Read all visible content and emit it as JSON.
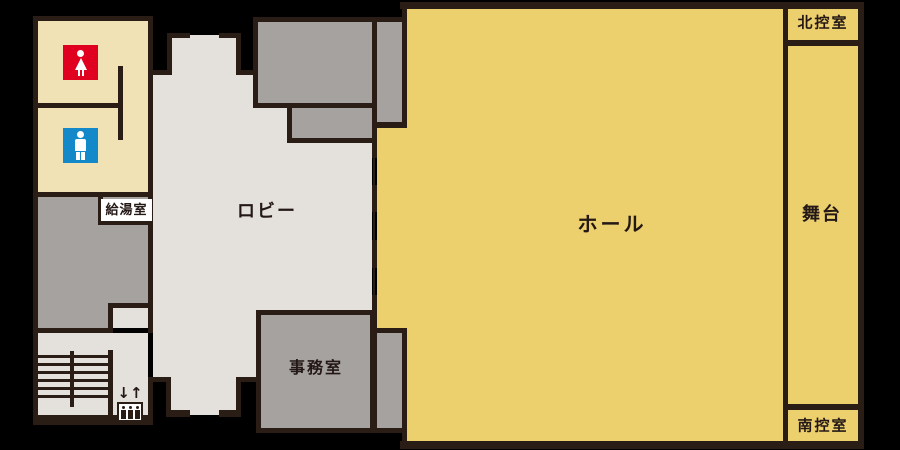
{
  "colors": {
    "bg": "#000000",
    "wall": "#2a1d15",
    "hall": "#edd06e",
    "cream": "#f0e2b5",
    "lobby": "#e4e1dd",
    "room": "#a5a2a0",
    "text": "#231815",
    "womens": "#e00020",
    "mens": "#1489ca",
    "white": "#ffffff"
  },
  "rooms": {
    "hall": "ホール",
    "stage": "舞台",
    "north_room": "北控室",
    "south_room": "南控室",
    "lobby": "ロビー",
    "office": "事務室",
    "kitchenette": "給湯室"
  },
  "elevator": {
    "arrows": "↓↑"
  }
}
